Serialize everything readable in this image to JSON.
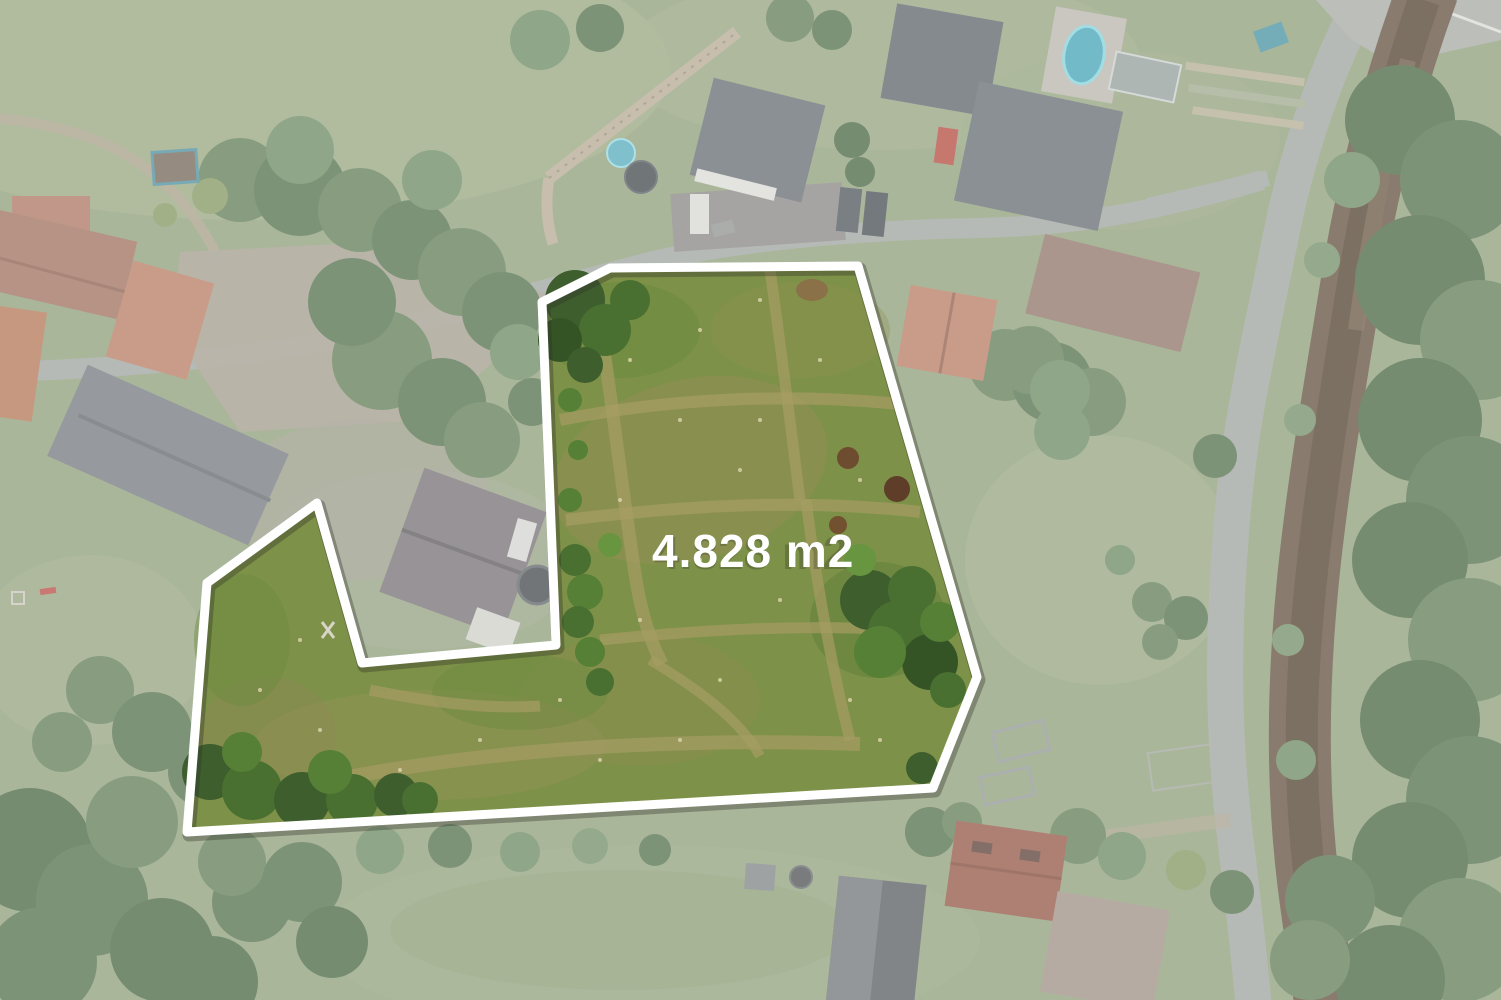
{
  "photo": {
    "description": "Aerial drone view of a village land plot highlighted for sale",
    "area_label": "4.828 m2"
  },
  "plot": {
    "outline_points": "542,302 610,268 858,266 977,677 933,788 187,832 207,583 317,503 362,663 556,645",
    "outline_color": "#ffffff",
    "meadow_color": "#7d9148",
    "label_color": "#ffffff"
  }
}
